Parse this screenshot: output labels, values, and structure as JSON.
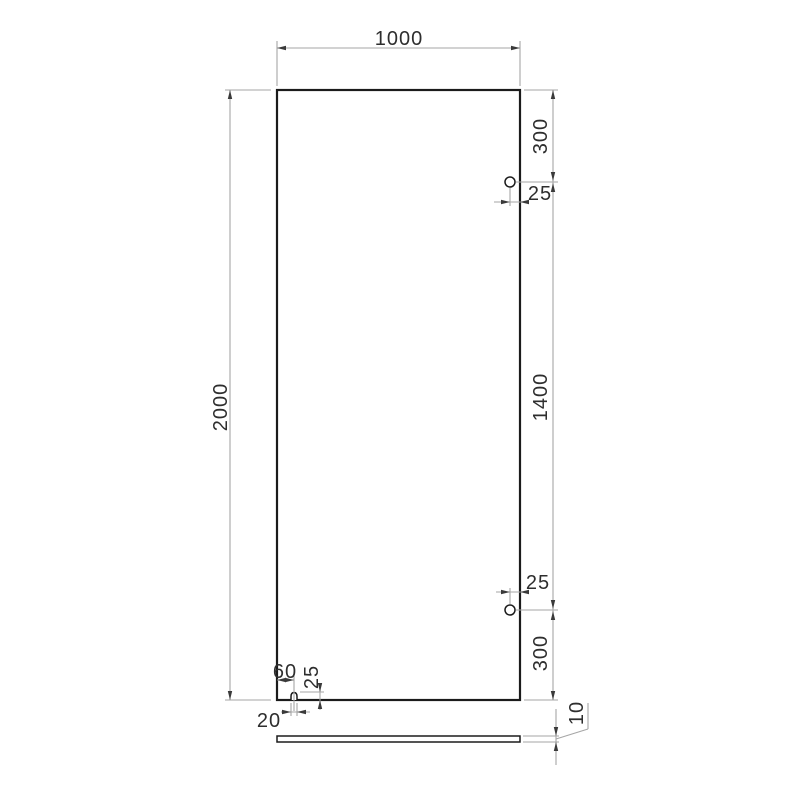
{
  "drawing": {
    "kind": "glass-panel-dimension-drawing",
    "dimensions": {
      "panel_width": "1000",
      "panel_height": "2000",
      "top_hole_from_top": "300",
      "top_hole_from_edge": "25",
      "hole_to_hole": "1400",
      "bottom_hole_from_edge": "25",
      "bottom_hole_from_bottom": "300",
      "notch_center_from_left": "60",
      "notch_depth": "25",
      "notch_width": "20",
      "glass_thickness": "10"
    },
    "colors": {
      "outline": "#1b1b1b",
      "dimension_line": "#a6a6a6",
      "text": "#2e2e2e",
      "arrow": "#3a3a3a",
      "background": "#ffffff"
    }
  }
}
